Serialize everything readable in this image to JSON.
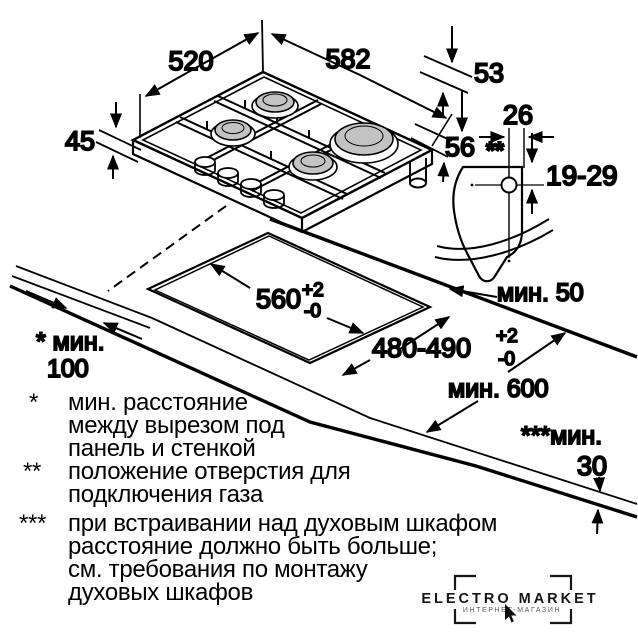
{
  "colors": {
    "line": "#000000",
    "burner_fill": "#c3c3c3",
    "background": "#ffffff",
    "watermark": "#161616"
  },
  "hob": {
    "dim_depth": "520",
    "dim_width": "582",
    "dim_53": "53",
    "dim_45": "45",
    "dim_56": "56"
  },
  "gas_connection": {
    "dim_26": "26",
    "marker": "**",
    "dim_19_29": "19-29"
  },
  "cutout": {
    "width": "560",
    "width_tol_plus": "+2",
    "width_tol_minus": "-0",
    "depth": "480-490",
    "depth_tol_plus": "+2",
    "depth_tol_minus": "-0",
    "min_back": "мин. 50",
    "min_side_label": "* мин.",
    "min_side_value": "100",
    "min_worktop_depth": "мин. 600",
    "min_oven_label": "***мин.",
    "min_oven_value": "30"
  },
  "footnotes": [
    {
      "marker": "*",
      "lines": [
        "мин. расстояние",
        "между вырезом под",
        "панель и стенкой"
      ]
    },
    {
      "marker": "**",
      "lines": [
        "положение отверстия для",
        "подключения газа"
      ]
    },
    {
      "marker": "***",
      "lines": [
        "при встраивании над духовым шкафом",
        "расстояние должно быть больше;",
        "см. требования по монтажу",
        "духовых шкафов"
      ]
    }
  ],
  "watermark": {
    "title": "ELECTRO MARKET",
    "subtitle": "ИНТЕРНЕТ-МАГАЗИН"
  }
}
